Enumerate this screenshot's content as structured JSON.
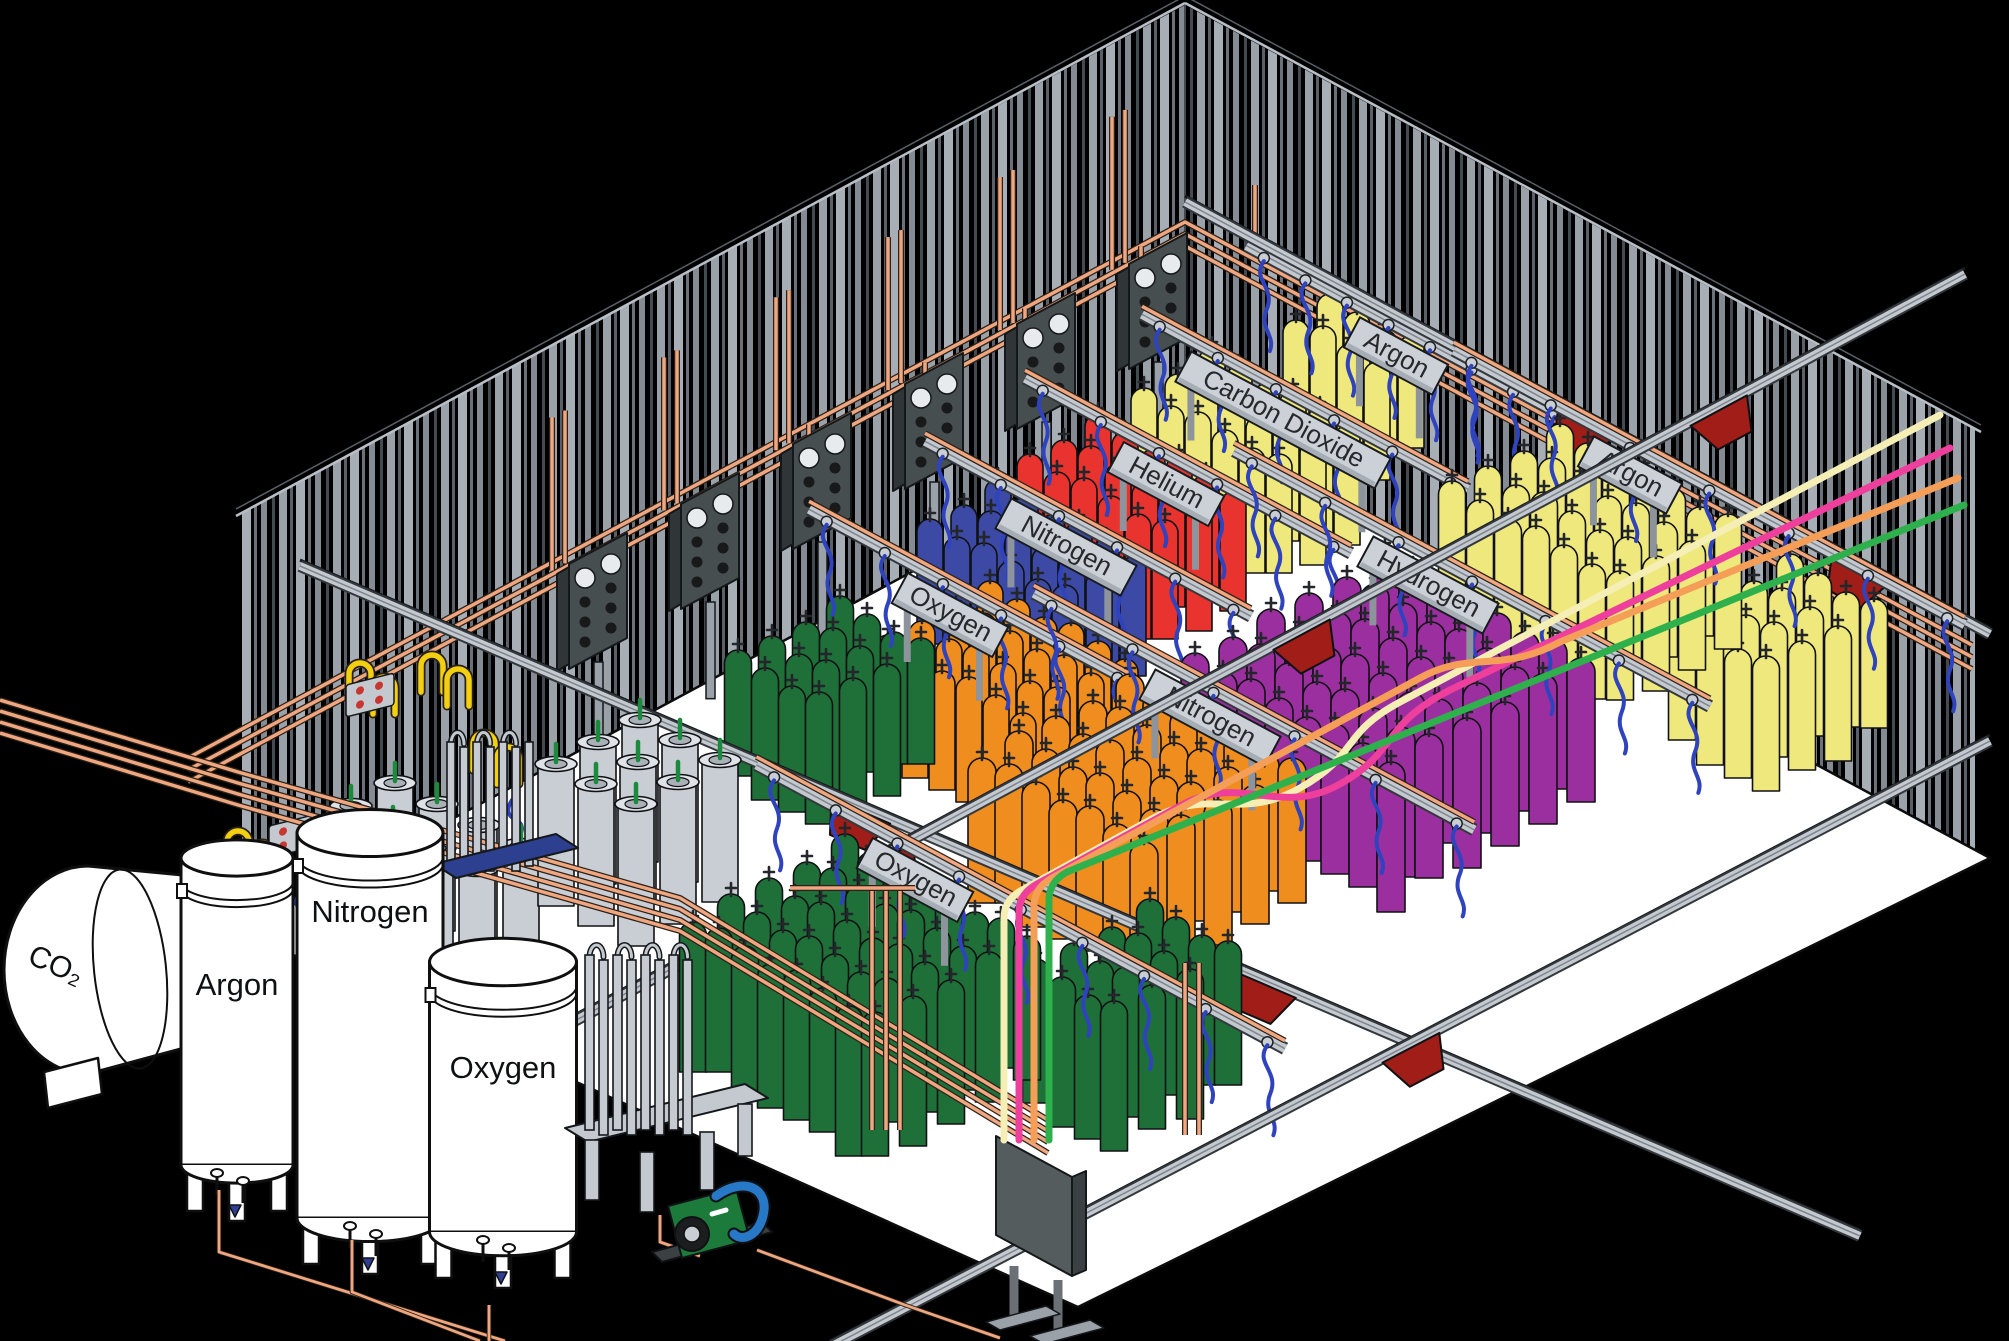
{
  "title": "Gas cylinder filling plant - isometric cutaway illustration",
  "storage_tanks": [
    {
      "id": "co2-tank",
      "label": "CO₂"
    },
    {
      "id": "argon-tank",
      "label": "Argon"
    },
    {
      "id": "nitrogen-tank",
      "label": "Nitrogen"
    },
    {
      "id": "oxygen-tank",
      "label": "Oxygen"
    }
  ],
  "racks": [
    {
      "id": "argon-top",
      "label": "Argon",
      "cylinder_color": "#efe87d"
    },
    {
      "id": "carbon-dioxide",
      "label": "Carbon Dioxide",
      "cylinder_color": "#efe87d"
    },
    {
      "id": "helium",
      "label": "Helium",
      "cylinder_color": "#e8332f"
    },
    {
      "id": "nitrogen-back",
      "label": "Nitrogen",
      "cylinder_color": "#3c4aa5"
    },
    {
      "id": "oxygen-back",
      "label": "Oxygen",
      "cylinder_color": "#1e7038",
      "companion_cylinder_color": "#ef8d1f"
    },
    {
      "id": "argon-right",
      "label": "Argon",
      "cylinder_color": "#efe87d"
    },
    {
      "id": "hydrogen",
      "label": "Hydrogen",
      "cylinder_color": "#9c2f9f"
    },
    {
      "id": "nitrogen-center",
      "label": "Nitrogen",
      "cylinder_color": "#ef8d1f"
    },
    {
      "id": "oxygen-front",
      "label": "Oxygen",
      "cylinder_color": "#1e7038"
    }
  ],
  "transfer_lines": [
    {
      "name": "cream",
      "color": "#f5efb6"
    },
    {
      "name": "pink",
      "color": "#ee3f9d"
    },
    {
      "name": "orange",
      "color": "#f49e58"
    },
    {
      "name": "green",
      "color": "#2eb14c"
    }
  ],
  "palette": {
    "floor": "#ffffff",
    "wall_stripe_light": "#9aa1a9",
    "wall_stripe_bright": "#a7aeb6",
    "wall_stripe_mid": "#848b93",
    "wall_stripe_dark": "#59606a",
    "copper": "#f0a67e",
    "copper_outline": "#2a211a",
    "steel": "#c4c9d0",
    "steel_dark": "#33383d",
    "steel_mid": "#7e858d",
    "hose_blue": "#2e43bd",
    "cart_red": "#a01d18",
    "sign_plate": "#ccd1d7",
    "sign_text": "#26292c",
    "manifold_panel": "#474e50",
    "dewar_gray": "#c9ced5",
    "valve_green": "#1c8a3c",
    "vaporizer_base_blue": "#2d3f8f",
    "pump_green": "#1c7a3a",
    "pump_handle_blue": "#2878c8",
    "fill_pipe_yellow": "#f3cf12"
  }
}
